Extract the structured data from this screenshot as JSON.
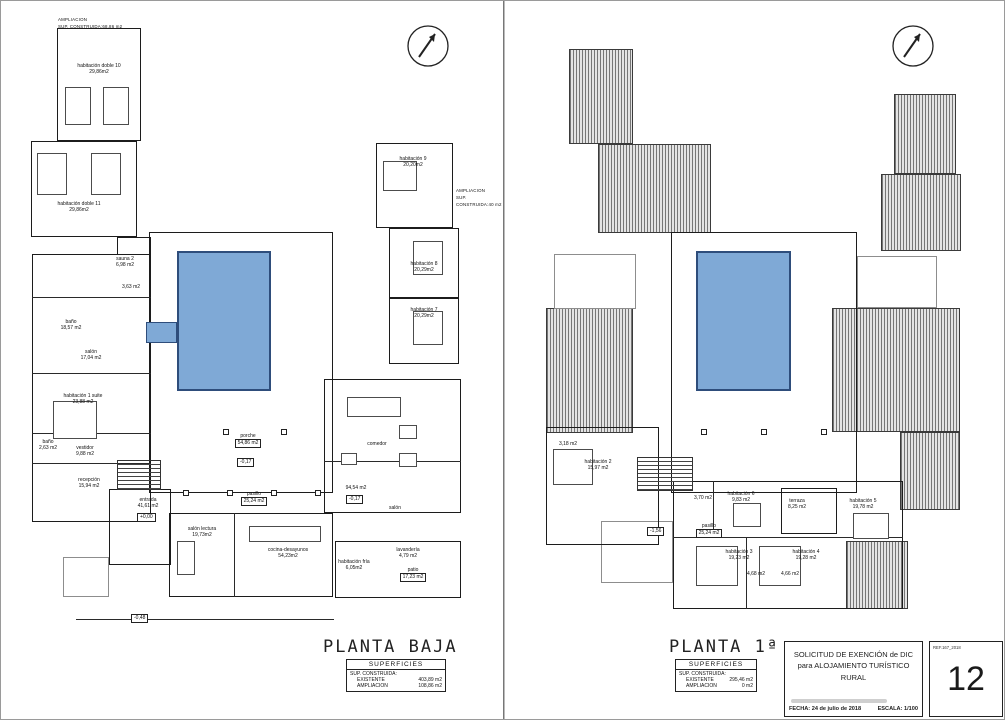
{
  "colors": {
    "pool_fill": "#7fa9d6",
    "pool_border": "#2e4d7b",
    "roof_line": "#767676",
    "line": "#1c1c1c"
  },
  "sheets": {
    "left": {
      "title": "PLANTA BAJA",
      "notes": {
        "top": {
          "line1": "AMPLIACION",
          "line2": "SUP. CONSTRUIDA:68,86 m2"
        },
        "right": {
          "line1": "AMPLIACION",
          "line2": "SUP. CONSTRUIDA:40 m2"
        }
      },
      "rooms": [
        {
          "label": "habitación doble 10",
          "area": "29,86m2"
        },
        {
          "label": "habitación doble 11",
          "area": "29,86m2"
        },
        {
          "label": "habitación 9",
          "area": "20,20m2"
        },
        {
          "label": "habitación 8",
          "area": "20,29m2"
        },
        {
          "label": "habitación 7",
          "area": "20,29m2"
        },
        {
          "label": "sauna 2",
          "area": "6,98 m2"
        },
        {
          "label": "aseo",
          "area": "3,63 m2"
        },
        {
          "label": "baño",
          "area": "18,57 m2"
        },
        {
          "label": "salón",
          "area": "17,04 m2"
        },
        {
          "label": "habitación 1 suite",
          "area": "23,88 m2"
        },
        {
          "label": "baño",
          "area": "2,63 m2"
        },
        {
          "label": "vestidor",
          "area": "9,88 m2"
        },
        {
          "label": "recepción",
          "area": "15,94 m2"
        },
        {
          "label": "entrada",
          "area": "41,61 m2"
        },
        {
          "label": "porche",
          "area": "54,86 m2"
        },
        {
          "label": "pasillo",
          "area": "25,24 m2"
        },
        {
          "label": "salón lectura",
          "area": "19,73m2"
        },
        {
          "label": "cocina-desayunos",
          "area": "54,23m2"
        },
        {
          "label": "comedor",
          "area": ""
        },
        {
          "label": "",
          "area": "94,54 m2"
        },
        {
          "label": "salón",
          "area": ""
        },
        {
          "label": "lavandería",
          "area": "4,79 m2"
        },
        {
          "label": "patio",
          "area": "17,23 m2"
        },
        {
          "label": "habitación fría",
          "area": "6,05m2"
        }
      ],
      "levels": [
        "+0,00",
        "-0,17",
        "-0,17",
        "-0,48"
      ],
      "superficies": {
        "title": "SUPERFICIES",
        "header": "SUP. CONSTRUIDA:",
        "rows": [
          {
            "name": "EXISTENTE",
            "value": "403,89 m2"
          },
          {
            "name": "AMPLIACION",
            "value": "108,86 m2"
          }
        ]
      }
    },
    "right": {
      "title": "PLANTA 1ª",
      "rooms": [
        {
          "label": "habitación 2",
          "area": "15,97 m2"
        },
        {
          "label": "baño",
          "area": "3,18 m2"
        },
        {
          "label": "pasillo",
          "area": "25,24 m2"
        },
        {
          "label": "baño",
          "area": "3,70 m2"
        },
        {
          "label": "habitación 6",
          "area": "9,83 m2"
        },
        {
          "label": "terraza",
          "area": "8,25 m2"
        },
        {
          "label": "habitación 5",
          "area": "19,78 m2"
        },
        {
          "label": "habitación 3",
          "area": "19,23 m2"
        },
        {
          "label": "habitación 4",
          "area": "19,28 m2"
        },
        {
          "label": "baño",
          "area": "4,68 m2"
        },
        {
          "label": "baño",
          "area": "4,66 m2"
        }
      ],
      "levels": [
        "-1,56"
      ],
      "superficies": {
        "title": "SUPERFICIES",
        "header": "SUP. CONSTRUIDA:",
        "rows": [
          {
            "name": "EXISTENTE",
            "value": "295,46 m2"
          },
          {
            "name": "AMPLIACION",
            "value": "0 m2"
          }
        ]
      }
    }
  },
  "titleblock": {
    "line1": "SOLICITUD DE EXENCIÓN de DIC",
    "line2": "para ALOJAMIENTO TURÍSTICO RURAL",
    "fecha_label": "FECHA:",
    "fecha": "24 de julio de 2018",
    "escala_label": "ESCALA:",
    "escala": "1/100",
    "ref": "REF.167_2018",
    "page": "12"
  }
}
